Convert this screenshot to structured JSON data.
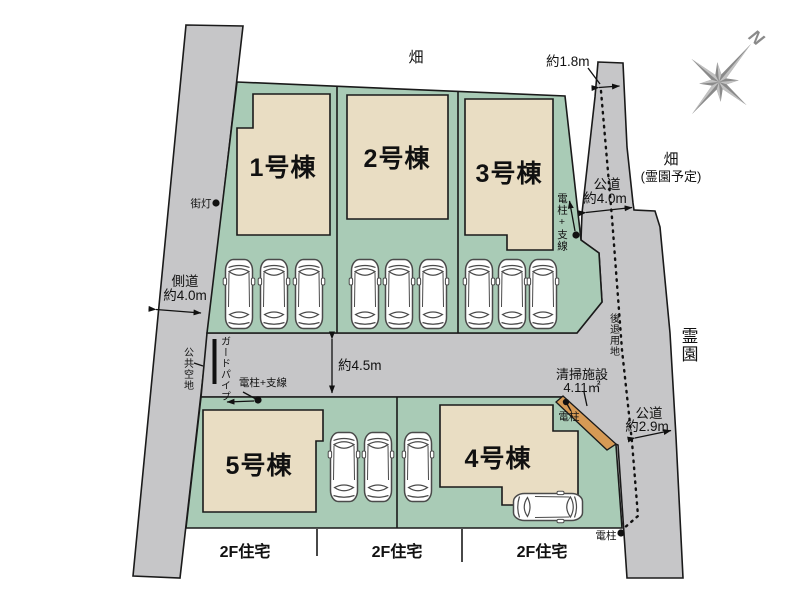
{
  "plan": {
    "colors": {
      "lot_green": "#a9cbb6",
      "road_gray": "#c6c6c8",
      "building_beige": "#e9ddc3",
      "cleaning_orange": "#d69a55",
      "compass_gray": "#8a8a8a",
      "line_black": "#1a1a1a"
    },
    "buildings": [
      {
        "label": "1号棟"
      },
      {
        "label": "2号棟"
      },
      {
        "label": "3号棟"
      },
      {
        "label": "4号棟"
      },
      {
        "label": "5号棟"
      }
    ],
    "annotations": {
      "field_top": "畑",
      "dim_east_entry": "約1.8m",
      "compass_north": "N",
      "field_east_line1": "畑",
      "field_east_line2": "(霊園予定)",
      "east_road_line1": "公道",
      "east_road_line2": "約4.0m",
      "pole_wire_east": "電柱+支線",
      "cemetery": "霊園",
      "setback_land": "後退用地",
      "cleaning_line1": "清掃施設",
      "cleaning_line2": "4.11㎡",
      "pole_mid": "電柱",
      "southeast_road_line1": "公道",
      "southeast_road_line2": "約2.9m",
      "dim_mid_road": "約4.5m",
      "guard_pipe": "ガードパイプ",
      "pole_wire_west": "電柱+支線",
      "public_open_space": "公共空地",
      "west_road_line1": "側道",
      "west_road_line2": "約4.0m",
      "street_light": "街灯",
      "pole_south": "電柱"
    },
    "south_houses": [
      "2F住宅",
      "2F住宅",
      "2F住宅"
    ]
  }
}
